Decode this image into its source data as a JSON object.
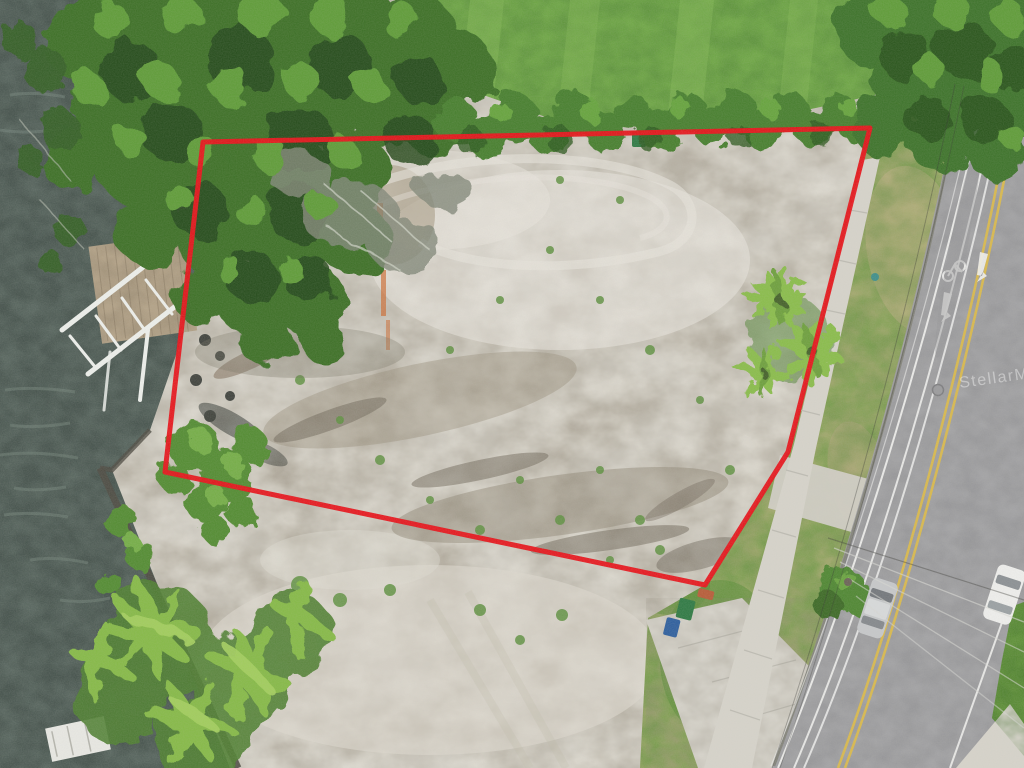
{
  "scene": {
    "description": "Aerial drone photo of a cleared waterfront vacant lot outlined in red, river with dock on the left, tree canopy at top, road with cars on the right",
    "watermark": "StellarMLS"
  },
  "palette": {
    "water": "#46534d",
    "water_ripple": "#6b7a72",
    "dirt": "#ccc8be",
    "dirt_dark": "#8f8573",
    "dirt_light": "#efece3",
    "grass_field": "#6fa746",
    "grass_strip": "#84a355",
    "grass_dry": "#b9ac80",
    "tree_base": "#3c7028",
    "tree_dark": "#25481a",
    "tree_light": "#5f9c38",
    "palm_light": "#8abd4b",
    "palm_mid": "#6ea03c",
    "road": "#a3a3a5",
    "concrete": "#d7d4cb",
    "curb": "#83837a",
    "boundary_red": "#e8131a",
    "yellow_line": "#d9b94e",
    "white_line": "#efefed",
    "dock_wood": "#b3a287",
    "boat_lift_white": "#eef0ec",
    "seawall": "#4e4b42",
    "car_silver": "#c6c8ca",
    "car_white": "#efefed",
    "bin_green": "#2f7a44",
    "bin_blue": "#2e5f9e",
    "bin_pink": "#cc8186",
    "safety_orange": "#cf6a2f"
  },
  "boundary": {
    "points": "203,142 870,128 788,452 705,585 165,472",
    "stroke_width": 5
  }
}
